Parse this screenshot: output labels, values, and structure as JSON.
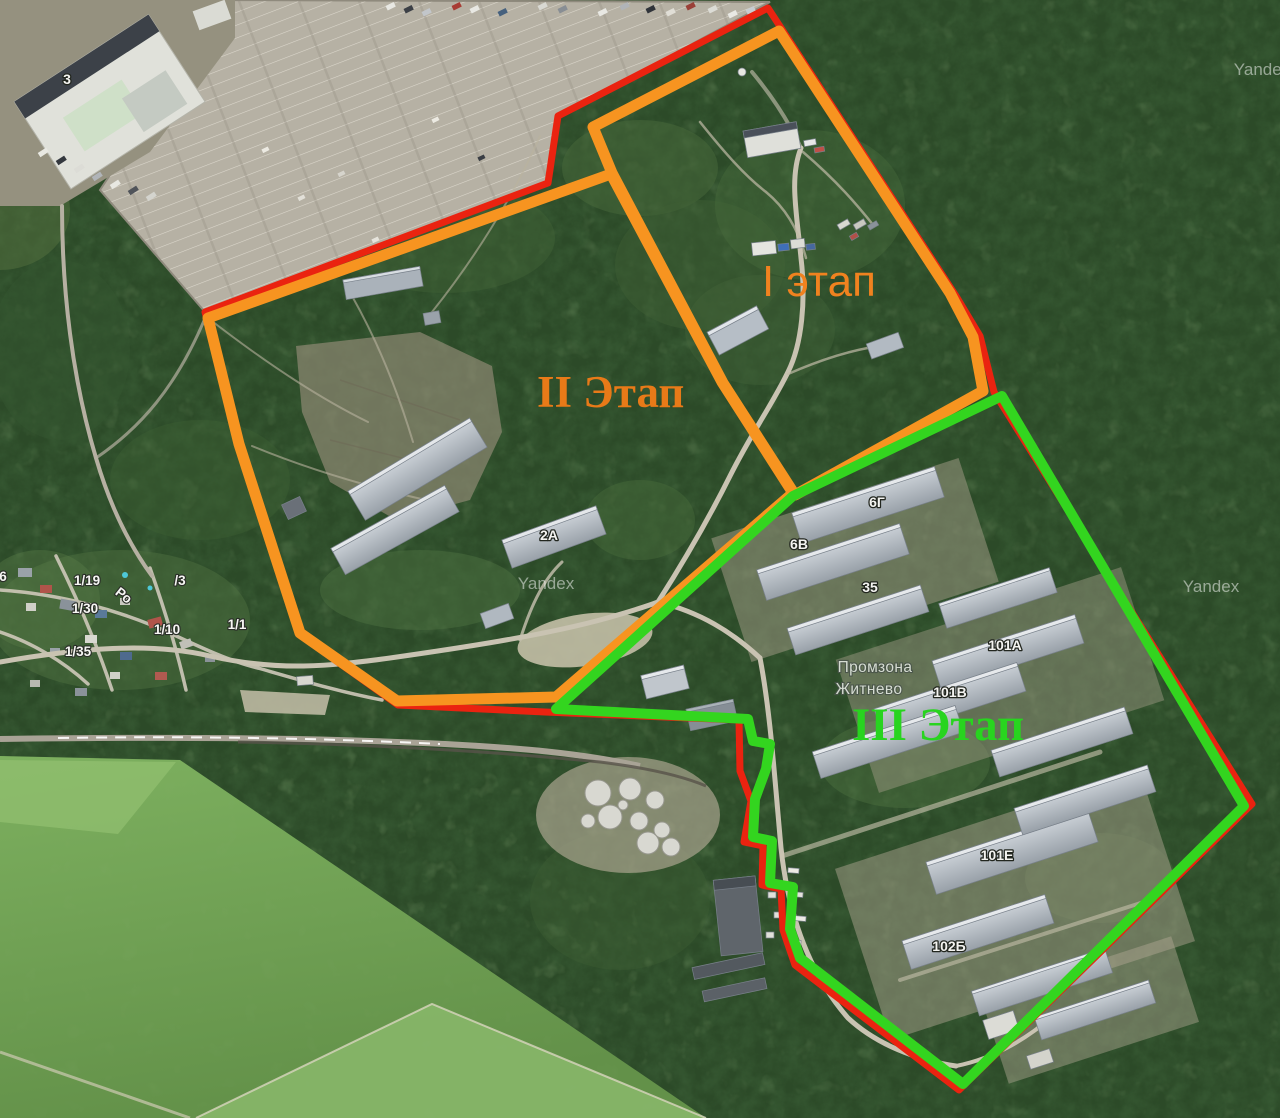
{
  "map": {
    "provider_watermark": "Yandex",
    "place_label": {
      "line1": "Промзона",
      "line2": "Житнево"
    },
    "phases": [
      {
        "label": "I этап",
        "color": "#f0821f"
      },
      {
        "label": "II Этап",
        "color": "#e87a18"
      },
      {
        "label": "III Этап",
        "color": "#28d41f"
      }
    ],
    "colors": {
      "site_boundary": "#ea2310",
      "phase_1_2_boundary": "#f79420",
      "phase_3_boundary": "#33d51f"
    },
    "building_labels": [
      "3",
      "2А",
      "6Г",
      "6В",
      "35",
      "101А",
      "101В",
      "101Е",
      "102Б"
    ],
    "parcel_labels": [
      "6",
      "1/19",
      "/3",
      "1/30",
      "1/10",
      "1/1",
      "1/35"
    ],
    "road_label": "Ро"
  }
}
